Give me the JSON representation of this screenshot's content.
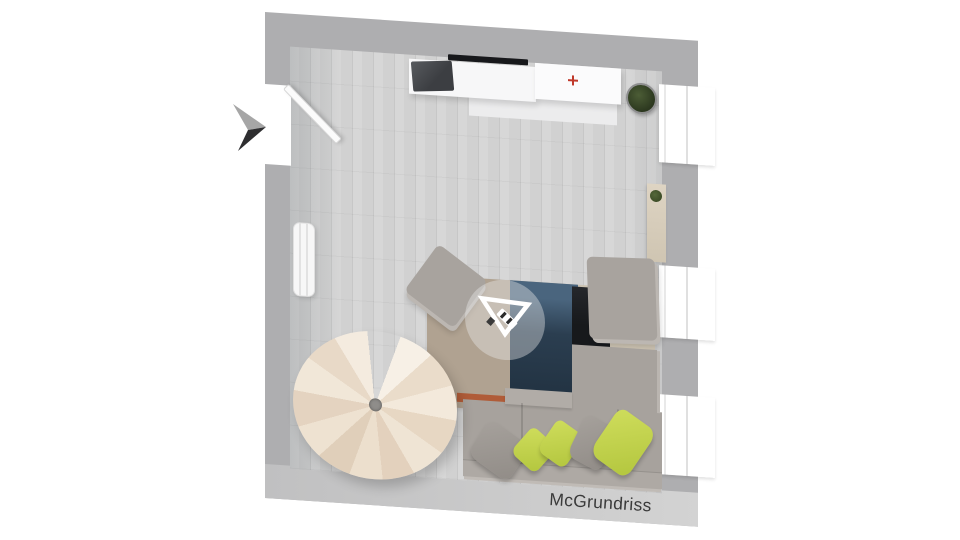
{
  "watermark": {
    "text": "McGrundriss"
  },
  "scene": {
    "description": "3D top-down floor plan render of a living room",
    "architecture": {
      "walls_color": "#aeaeb0",
      "floor_color": "#d2d2d2",
      "windows_count": 3,
      "door_state": "open",
      "entry_marker": "black-3d-arrow"
    },
    "furniture": [
      {
        "name": "spiral-staircase",
        "color": "#eee2d1"
      },
      {
        "name": "corner-sofa",
        "color": "#a7a29d"
      },
      {
        "name": "pillow-green",
        "color": "#c3d44d"
      },
      {
        "name": "pillow-gray",
        "color": "#9b9691"
      },
      {
        "name": "ottoman-rotated",
        "color": "#a8a39e"
      },
      {
        "name": "ottoman-right",
        "color": "#a8a39e"
      },
      {
        "name": "area-rug-taupe",
        "color": "#b0a291"
      },
      {
        "name": "area-rug-navy",
        "color": "#2b3e50"
      },
      {
        "name": "area-rug-black",
        "color": "#17191c"
      },
      {
        "name": "rug-accent-stripe",
        "color": "#b05c38"
      },
      {
        "name": "sideboard",
        "color": "#f7f7f8"
      },
      {
        "name": "flat-tv",
        "color": "#3c3e42"
      },
      {
        "name": "potted-plant",
        "color": "#2c381f"
      },
      {
        "name": "wall-console",
        "color": "#d8cec0"
      },
      {
        "name": "radiator",
        "color": "#f7f7f7"
      }
    ],
    "badge": {
      "shape": "inverted-triangle-logo",
      "color": "#ffffff"
    }
  }
}
